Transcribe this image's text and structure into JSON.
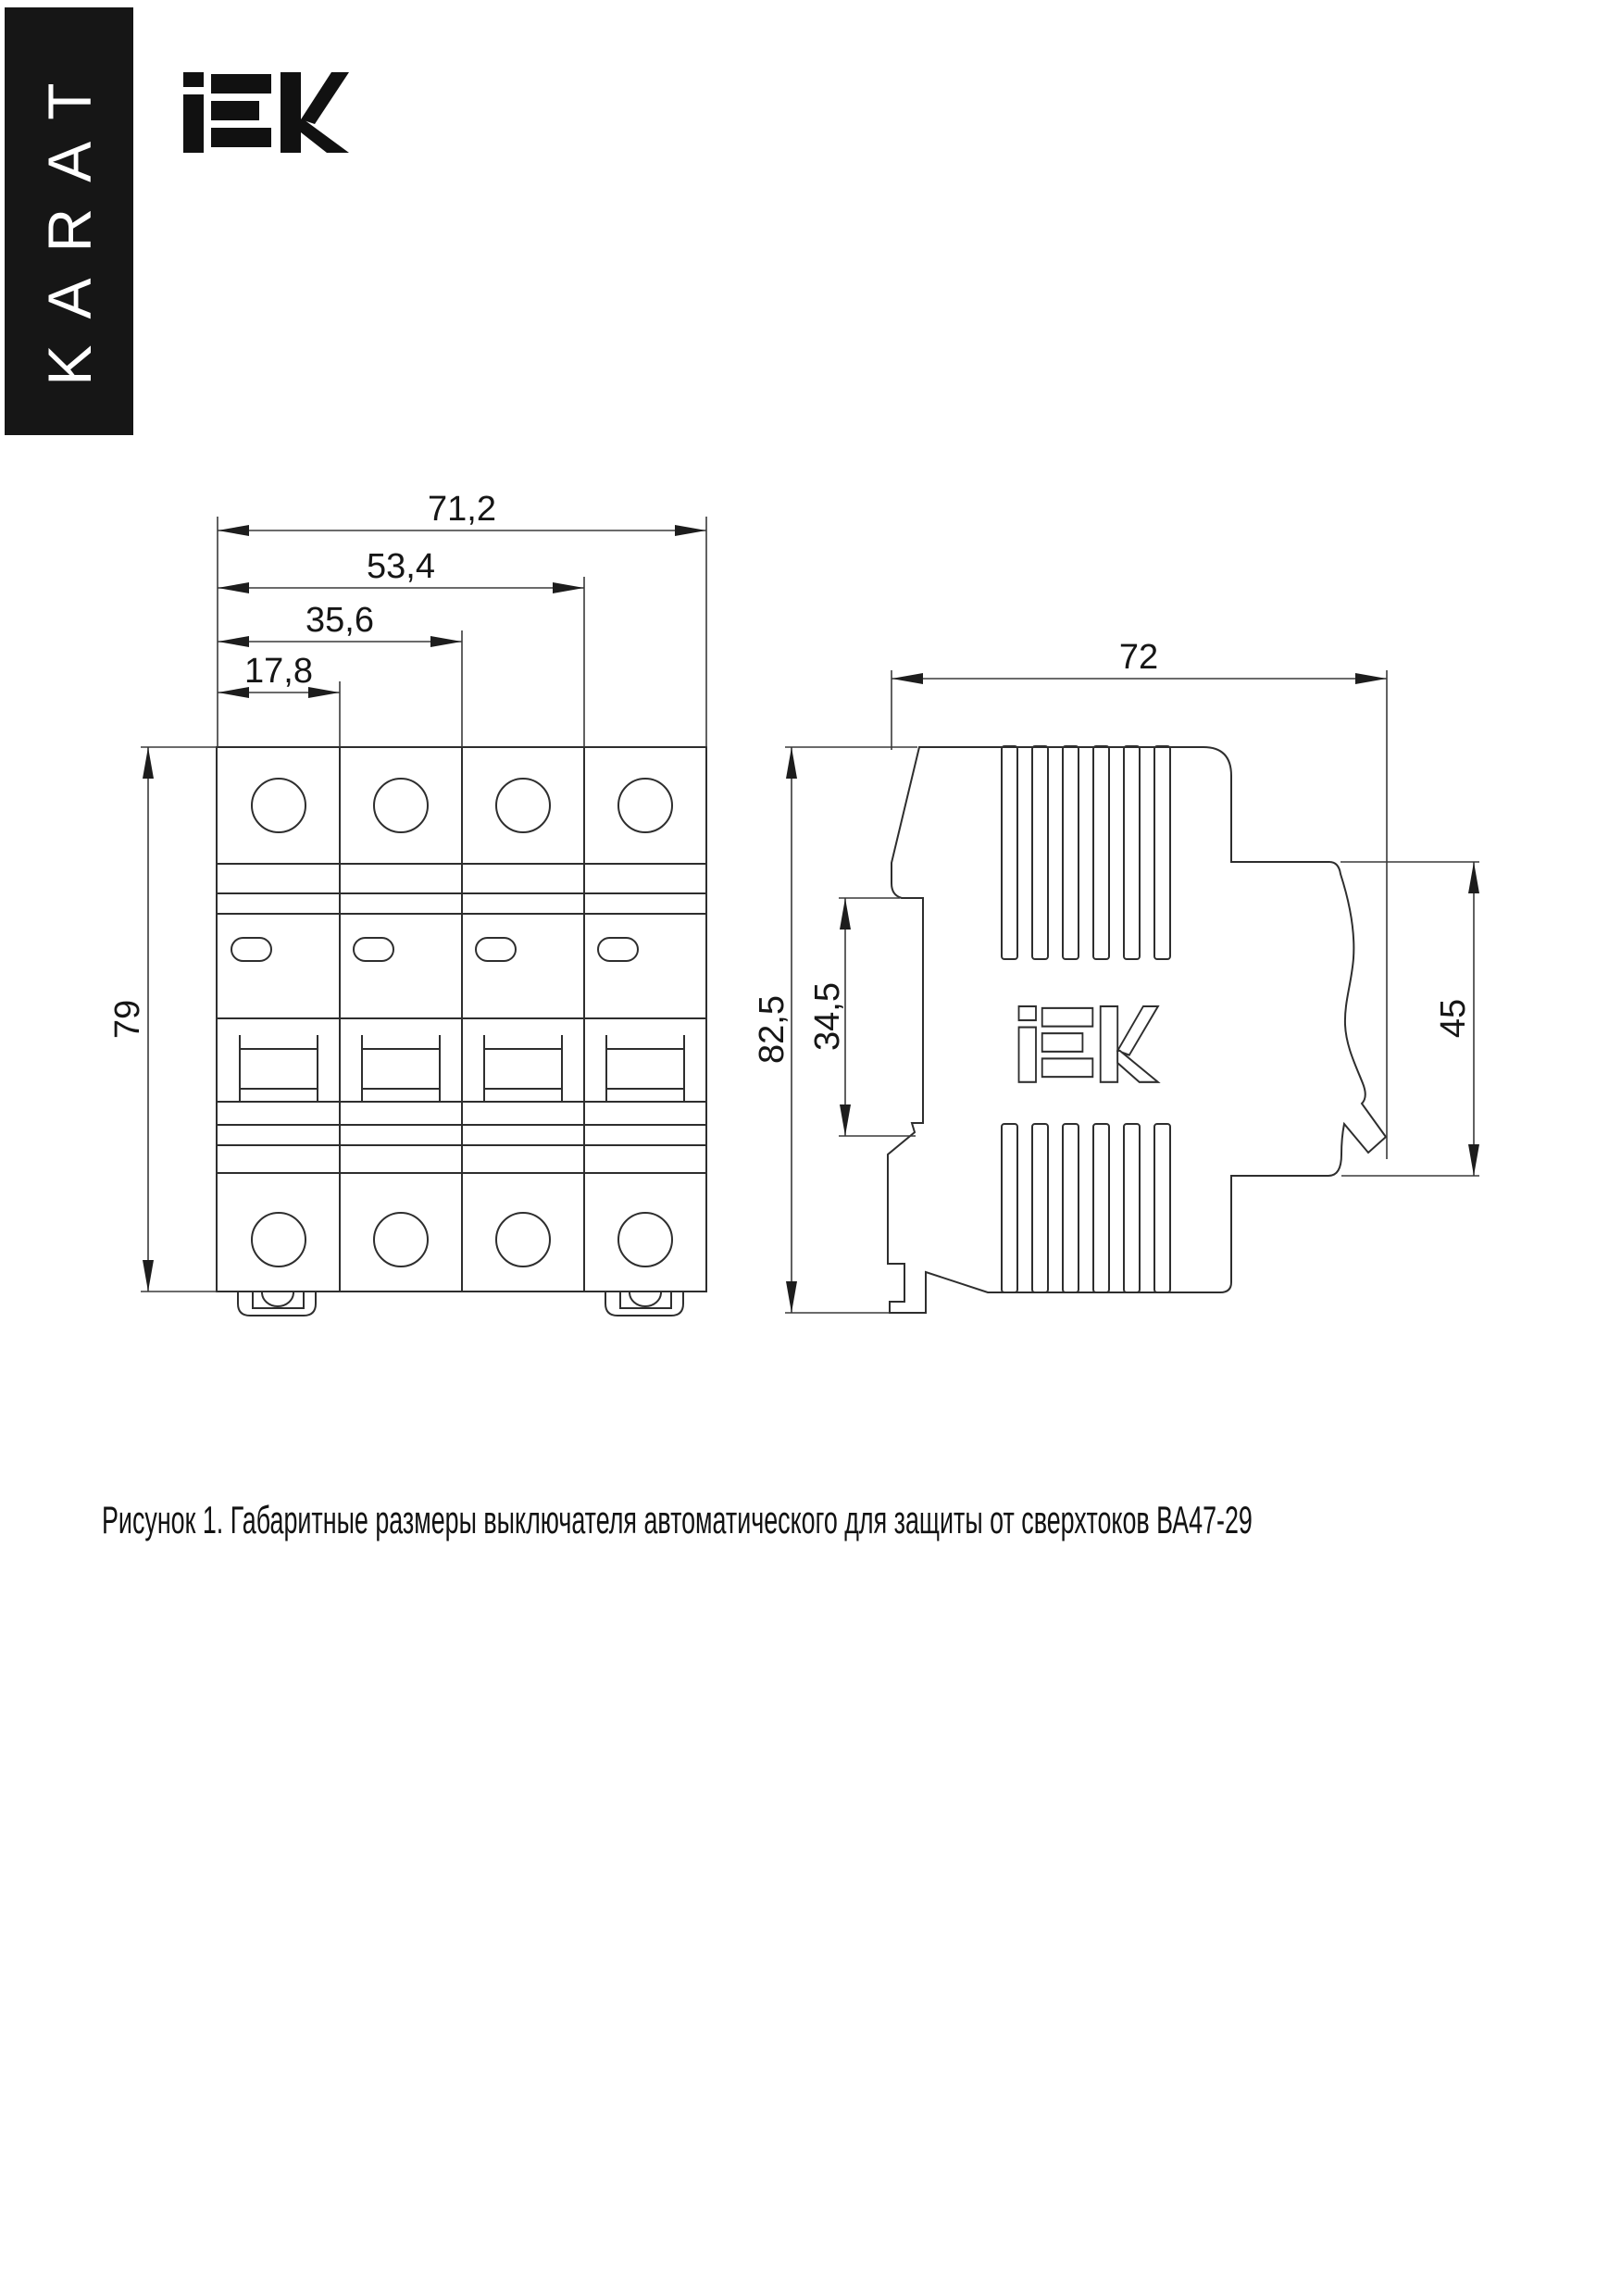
{
  "banner": {
    "label": "KARAT",
    "bg": "#161616",
    "fg": "#ffffff"
  },
  "brand": {
    "name": "IEK",
    "color": "#111111"
  },
  "figure": {
    "caption": "Рисунок 1. Габаритные размеры выключателя автоматического для защиты от сверхтоков ВА47-29",
    "product": "ВА47-29",
    "front_view": {
      "title": "front-view-4-module-breaker",
      "dimensions": {
        "total_width": "71,2",
        "width_3_modules": "53,4",
        "width_2_modules": "35,6",
        "width_1_module": "17,8",
        "height": "79"
      }
    },
    "side_view": {
      "title": "side-view-breaker-profile",
      "dimensions": {
        "depth": "72",
        "total_height": "82,5",
        "din_recess_height": "34,5",
        "front_part_height": "45"
      }
    },
    "line_color": "#2e2e2e",
    "text_color": "#161616"
  }
}
